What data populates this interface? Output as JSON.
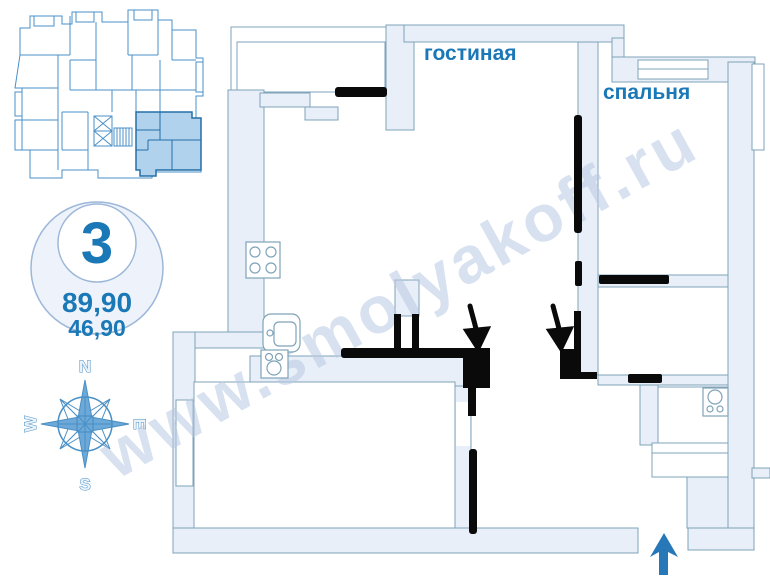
{
  "watermark": {
    "text": "www.smolyakoff.ru"
  },
  "badge": {
    "apartment_number": "3",
    "total_area": "89,90",
    "living_area": "46,90"
  },
  "rooms": {
    "living_room_label": "гостиная",
    "bedroom_label": "спальня"
  },
  "compass": {
    "north": "N",
    "east": "E",
    "south": "S",
    "west": "W"
  },
  "colors": {
    "label_blue": "#1a78b6",
    "wall_fill": "#e8eff8",
    "wall_stroke": "#7fa3b8",
    "keyplan_stroke": "#4a90c8",
    "highlight_fill": "#b0d2ec",
    "highlight_stroke": "#2470a8",
    "entrance_arrow": "#2878b8",
    "marking_black": "#0a0a0a",
    "watermark_color": "#b9c9e2"
  },
  "icons": {
    "stove": "stove-4-burners",
    "sink": "kitchen-sink",
    "hob": "cooktop",
    "toilet": "toilet",
    "elevators": "elevator-shafts",
    "stairs": "staircase",
    "entrance": "entrance-arrow",
    "pointers": "door-pointer-arrows"
  }
}
